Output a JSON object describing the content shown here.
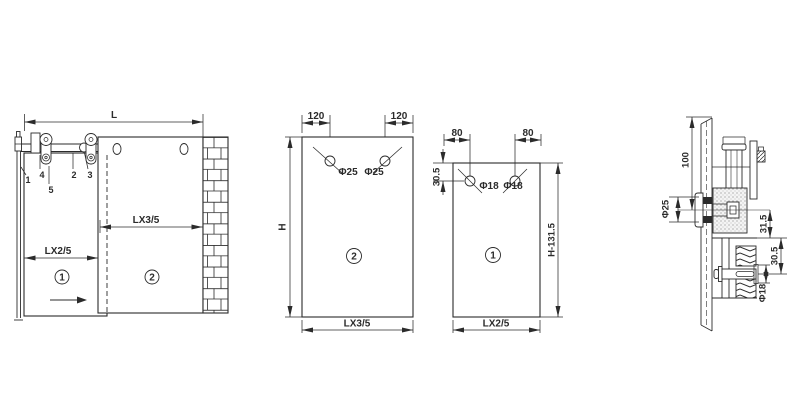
{
  "drawing": {
    "line_color": "#2b2b2b",
    "bg_color": "#ffffff",
    "elevation": {
      "dim_total_width": "L",
      "dim_fixed_width": "LX3/5",
      "dim_sliding_width": "LX2/5",
      "door1_tag": "1",
      "door2_tag": "2",
      "parts": {
        "track_end": "1",
        "track": "2",
        "spacer": "3",
        "end_block": "4",
        "hanger": "5"
      }
    },
    "fixed_panel": {
      "tag": "2",
      "dim_hole_left": "120",
      "dim_hole_right": "120",
      "hole_left": "Φ25",
      "hole_right": "Φ25",
      "dim_height": "H",
      "dim_width": "LX3/5"
    },
    "sliding_panel": {
      "tag": "1",
      "dim_hole_left": "80",
      "dim_hole_right": "80",
      "dim_hole_top": "30.5",
      "hole_left": "Φ18",
      "hole_right": "Φ18",
      "dim_height": "H-131.5",
      "dim_width": "LX2/5"
    },
    "section": {
      "dim_roller_height": "100",
      "dim_stud": "Φ25",
      "dim_stud_to_clamp": "31.5",
      "dim_clamp_to_bolt": "30.5",
      "dim_bolt": "Φ18"
    }
  }
}
